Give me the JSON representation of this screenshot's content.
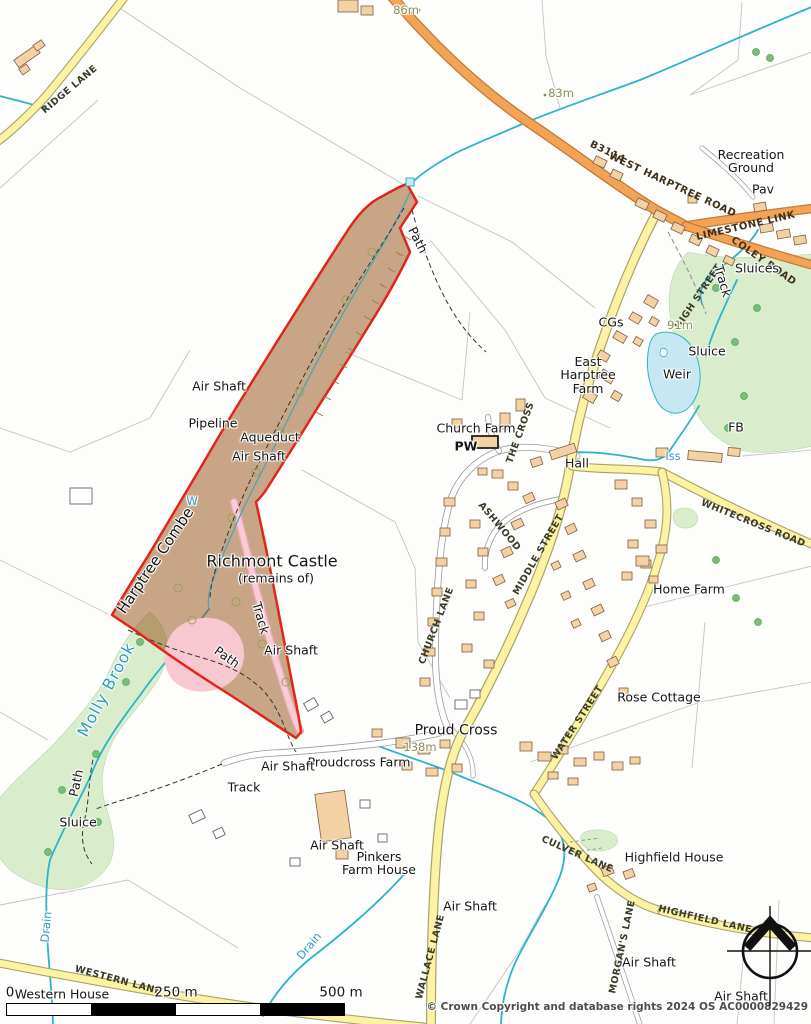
{
  "colors": {
    "site_boundary": "#e1251b",
    "site_fill": "rgba(147,77,17,0.5)",
    "main_road": "#f2a355",
    "minor_road": "#fbf3a3",
    "water": "#2fb3c9",
    "pond": "#c7e8f2",
    "woodland": "#d9edcc",
    "castle_pink": "#f8c8d1",
    "building": "#f2d2a5"
  },
  "labels": {
    "ridge_lane": "RIDGE LANE",
    "m86": "86m",
    "m83": "83m",
    "b3114": "B3114",
    "west_harptree_road": "WEST HARPTREE ROAD",
    "recreation_ground": "Recreation\nGround",
    "pav": "Pav",
    "limestone_link": "LIMESTONE LINK",
    "coley_road": "COLEY ROAD",
    "sluices": "Sluices",
    "high_street": "HIGH STREET",
    "track_ne": "Track",
    "cgs": "CGs",
    "m91": "91m",
    "sluice_r": "Sluice",
    "weir": "Weir",
    "east_harptree_farm": "East\nHarptree\nFarm",
    "fb": "FB",
    "church_farm": "Church Farm",
    "pw": "PW",
    "the_cross": "THE CROSS",
    "hall": "Hall",
    "iss": "Iss",
    "whitecross_road": "WHITECROSS ROAD",
    "ashwood": "ASHWOOD",
    "middle_street": "MIDDLE STREET",
    "church_lane": "CHURCH LANE",
    "air_shaft_1": "Air Shaft",
    "pipeline": "Pipeline",
    "aqueduct": "Aqueduct",
    "air_shaft_2": "Air Shaft",
    "path_1": "Path",
    "w_mark": "W",
    "harptree_combe": "Harptree Combe",
    "richmont_castle": "Richmont Castle",
    "remains_of": "(remains of)",
    "track_castle": "Track",
    "air_shaft_3": "Air Shaft",
    "path_2": "Path",
    "molly_brook": "Molly Brook",
    "path_3": "Path",
    "sluice_l": "Sluice",
    "drain_1": "Drain",
    "drain_2": "Drain",
    "western_lane": "WESTERN LANE",
    "western_house": "Western House",
    "proud_cross": "Proud Cross",
    "m138": "138m",
    "proudcross_farm": "Proudcross Farm",
    "air_shaft_4": "Air Shaft",
    "track_w": "Track",
    "air_shaft_5": "Air Shaft",
    "pinkers_farm_house": "Pinkers\nFarm House",
    "air_shaft_6": "Air Shaft",
    "wallace_lane": "WALLACE LANE",
    "culver_lane": "CULVER LANE",
    "highfield_house": "Highfield House",
    "morgans_lane": "MORGAN'S LANE",
    "highfield_lane": "HIGHFIELD LANE",
    "air_shaft_7": "Air Shaft",
    "air_shaft_8": "Air Shaft",
    "home_farm": "Home Farm",
    "rose_cottage": "Rose Cottage",
    "water_street": "WATER STREET"
  },
  "scale_bar": {
    "start": "0",
    "mid": "250 m",
    "end": "500 m"
  },
  "attribution": "© Crown Copyright and database rights 2024 OS AC0000829429"
}
